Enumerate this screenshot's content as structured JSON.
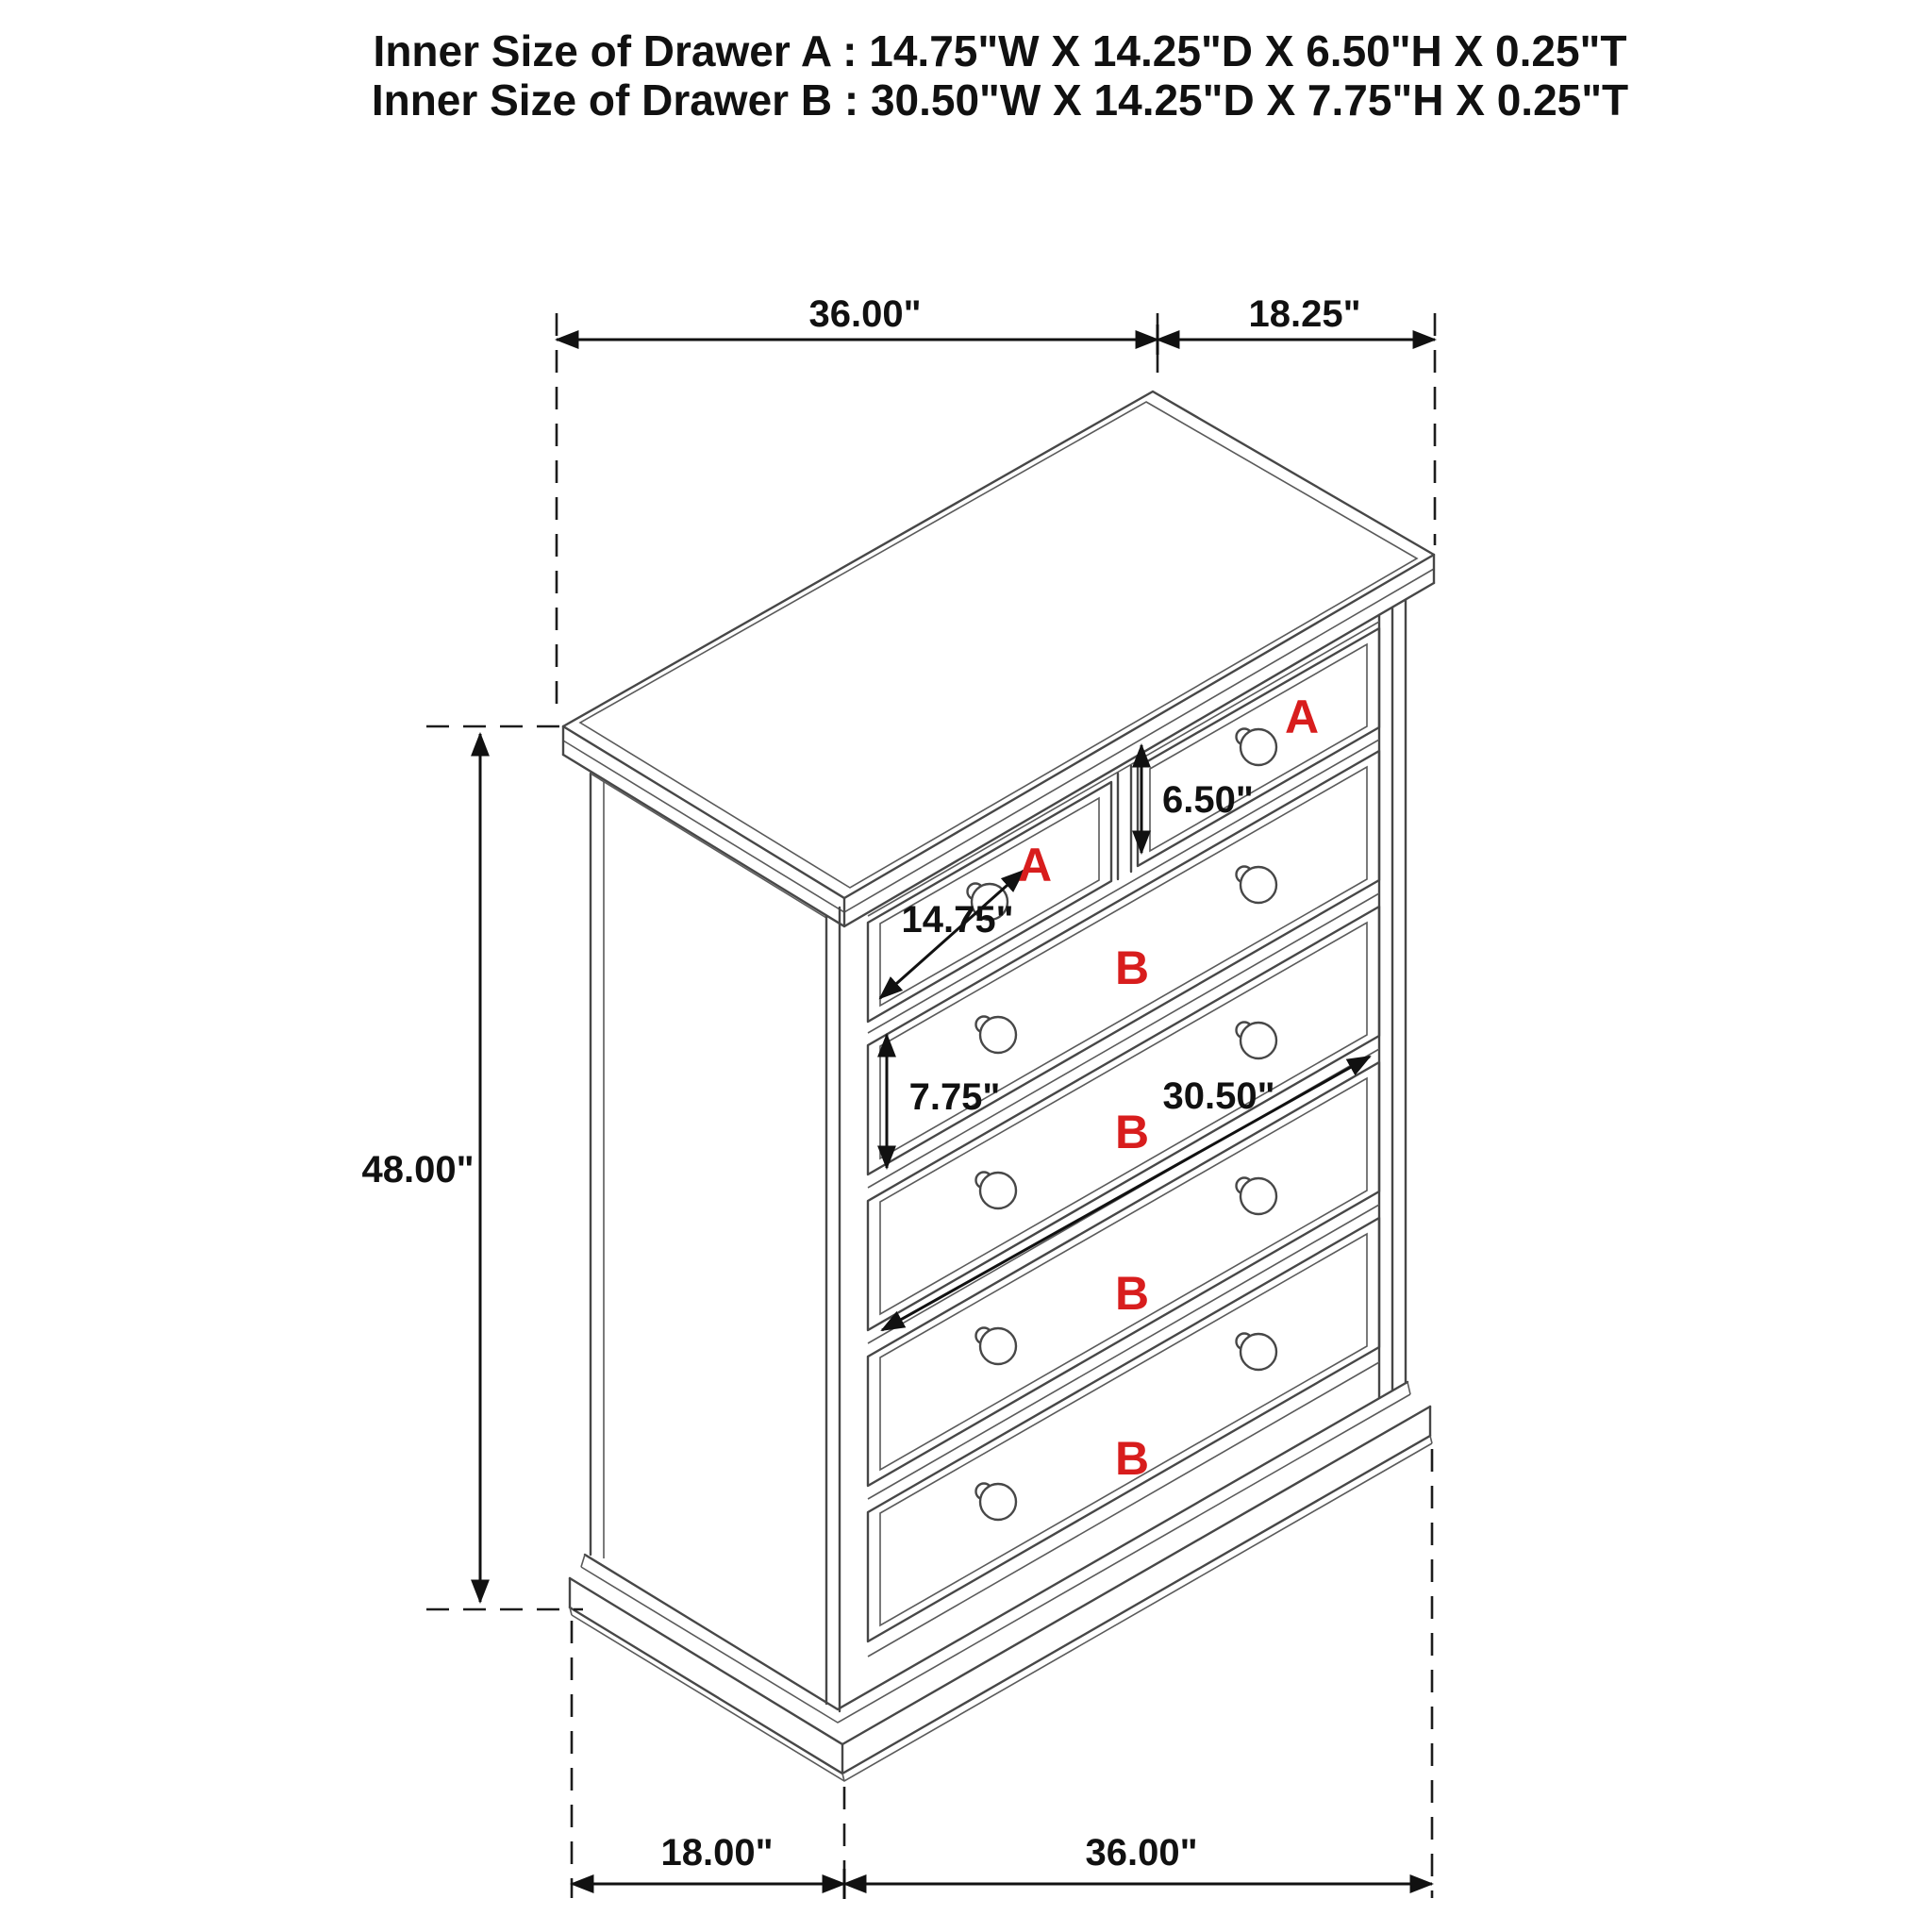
{
  "header": {
    "line1": "Inner Size of Drawer A : 14.75\"W X 14.25\"D X 6.50\"H X 0.25\"T",
    "line2": "Inner Size of Drawer B : 30.50\"W X 14.25\"D X 7.75\"H X 0.25\"T"
  },
  "dimensions": {
    "top_width": "36.00\"",
    "top_depth": "18.25\"",
    "overall_height": "48.00\"",
    "drawer_a_height": "6.50\"",
    "drawer_a_width": "14.75\"",
    "drawer_b_height": "7.75\"",
    "drawer_b_width": "30.50\"",
    "base_depth": "18.00\"",
    "base_width": "36.00\""
  },
  "drawer_labels": {
    "a_left": "A",
    "a_right": "A",
    "b1": "B",
    "b2": "B",
    "b3": "B",
    "b4": "B"
  },
  "colors": {
    "line": "#474747",
    "dimension": "#111111",
    "label_red": "#d81d1d",
    "background": "#ffffff"
  }
}
